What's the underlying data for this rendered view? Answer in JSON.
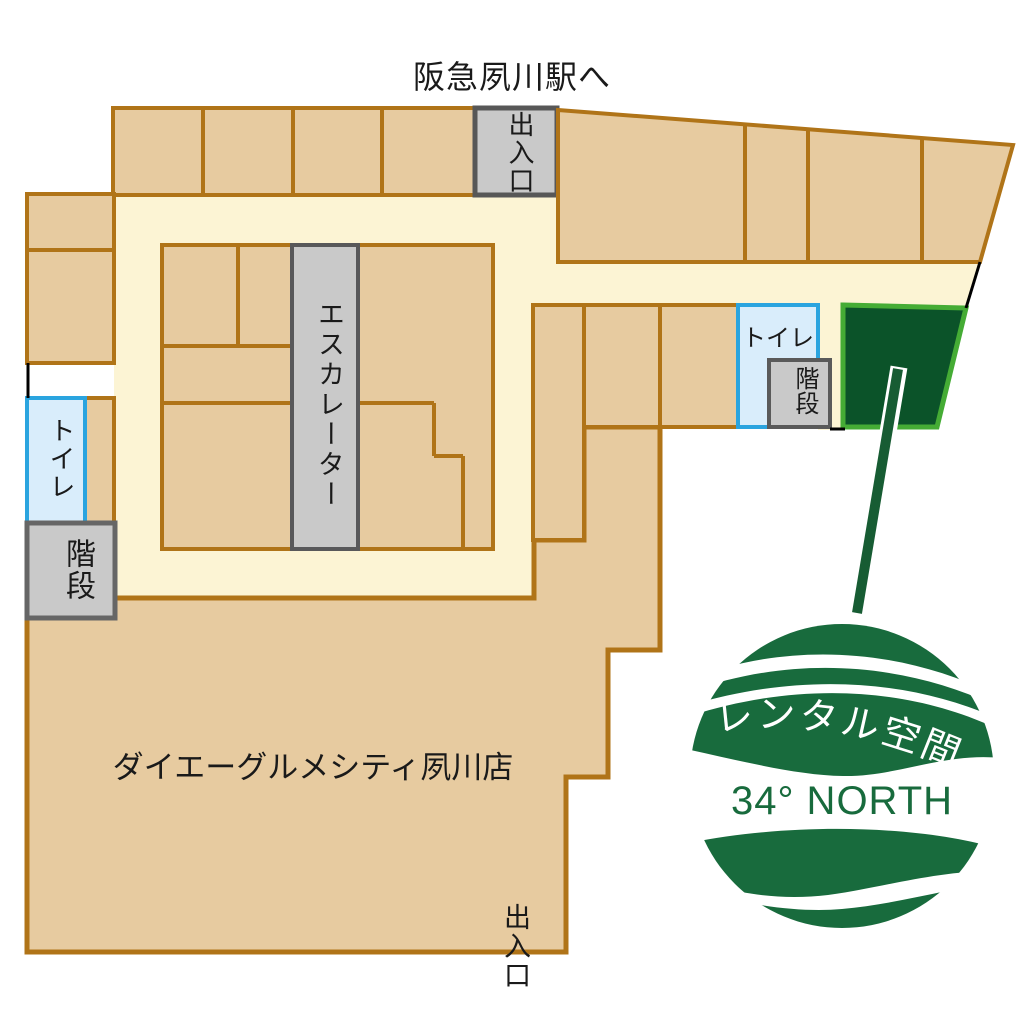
{
  "map": {
    "station_direction": "阪急夙川駅へ",
    "exit_top": "出入口",
    "exit_bottom": "出入口",
    "escalator": "エスカレーター",
    "toilet_left": "トイレ",
    "toilet_right": "トイレ",
    "stairs_left": "階段",
    "stairs_right": "階段",
    "anchor_store": "ダイエーグルメシティ夙川店"
  },
  "logo": {
    "band_text": "レンタル空間",
    "name_text": "34° NORTH"
  },
  "colors": {
    "shop_fill": "#e7cba0",
    "shop_border": "#b07418",
    "corridor": "#fcf4d4",
    "facility_gray_fill": "#c9c9c9",
    "facility_gray_border": "#575757",
    "toilet_fill": "#d9edfb",
    "toilet_border": "#2aa4df",
    "rental_space_fill": "#0b5329",
    "rental_space_border": "#45ac35",
    "pointer_green": "#175c33",
    "logo_green": "#186b3d",
    "text_color": "#1a1a1a"
  }
}
